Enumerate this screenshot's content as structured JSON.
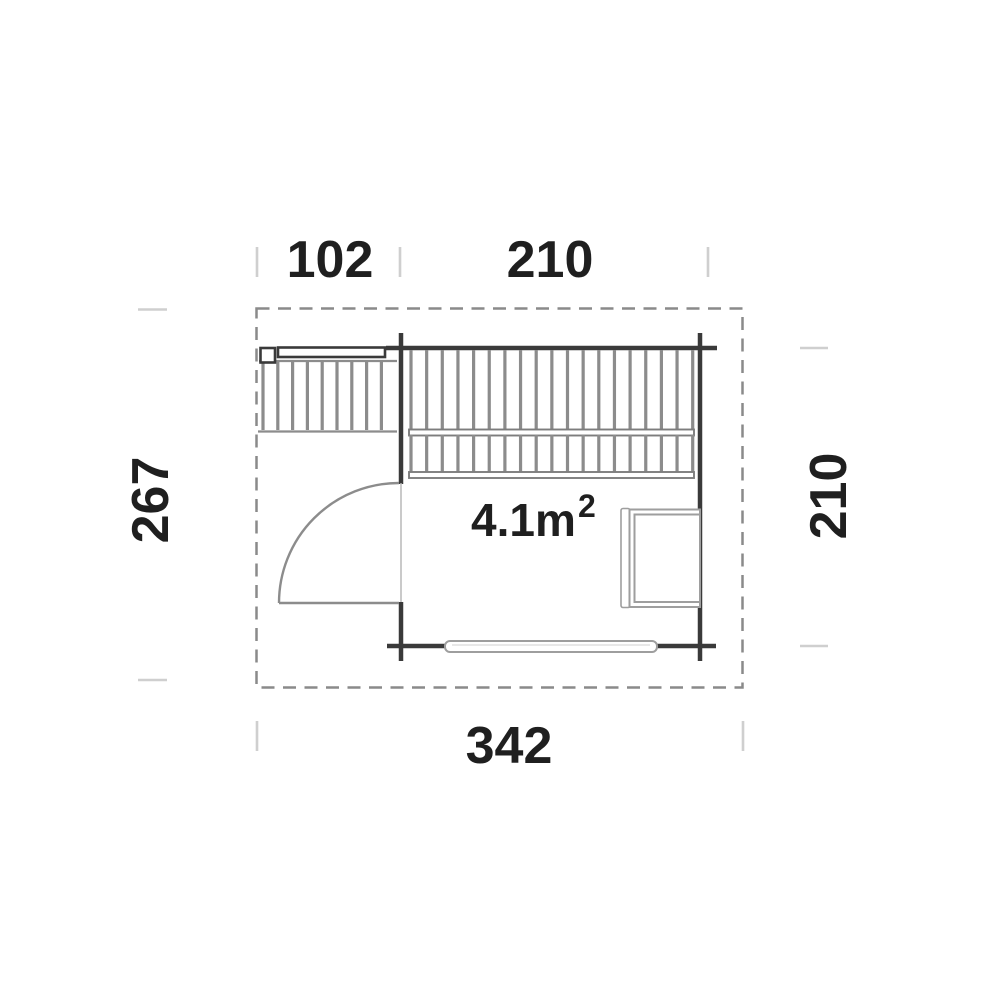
{
  "plan": {
    "area_label": {
      "value": "4.1m",
      "sup": "2"
    },
    "dimensions": {
      "terrace_width": "102",
      "room_width": "210",
      "total_height": "267",
      "room_depth": "210",
      "total_width": "342"
    }
  },
  "colors": {
    "background": "#ffffff",
    "wall": "#3a3a3a",
    "hatch": "#8c8c8c",
    "bar": "#7d7d7d",
    "furniture": "#9e9e9e",
    "door": "#8c8c8c",
    "outline_dashed": "#8a8a8a",
    "tick": "#cfcfcf",
    "text": "#1f1f1f"
  }
}
